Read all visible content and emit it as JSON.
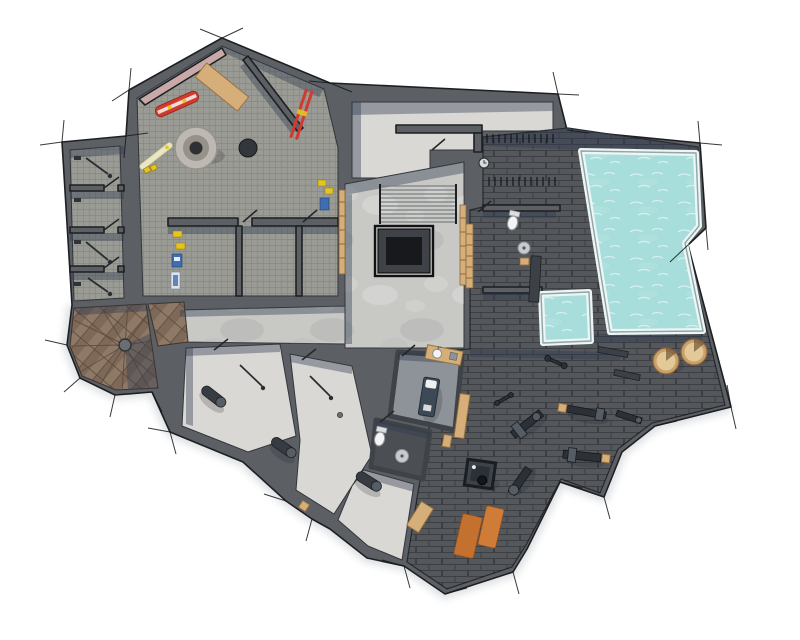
{
  "scene": {
    "type": "architectural-floor-plan",
    "style": "top-down-3d-render",
    "level": "basement-spa-level",
    "background": "#ffffff"
  },
  "colors": {
    "wall": "#5c6065",
    "wallDark": "#3f4348",
    "wallEdge": "#1d1f22",
    "carpet": "#9a9b95",
    "concrete": "#c8c8c5",
    "plaster": "#dad8d4",
    "tile": "#54585d",
    "tileDark": "#4b4f54",
    "massageFloor": "#8e9399",
    "water": "#a7ddda",
    "poolRim": "#edf5f5",
    "wood": "#d5ae79",
    "woodDark": "#8e7967",
    "shadow": "rgba(47,60,80,0.40)",
    "metal": "#2c3137",
    "metalLight": "#565c63",
    "fixture": "#f3f4f3",
    "mat": "#c4702f",
    "mat2": "#cf7c38",
    "red": "#d23a30",
    "yellow": "#e5c41f",
    "cream": "#eae6c2",
    "tub": "#c9a06a",
    "blue": "#3f6db0",
    "pinkWall": "#c9a9a7"
  },
  "rooms": [
    "ski-room",
    "equipment-lockers",
    "storage-wing",
    "stair-hall",
    "lobby",
    "spa",
    "swimming-pool-terrace",
    "wc",
    "massage-room",
    "gym",
    "cellar-rooms",
    "spiral-staircase-room"
  ],
  "fixtures": {
    "swimming_pool": 1,
    "plunge_pool": 1,
    "hot_tubs": 2,
    "toilets": 2,
    "sinks": 3,
    "massage_tables": 1,
    "gym_machines": 7,
    "yoga_mats": 2,
    "boot_dryer": 1,
    "snowboards": 1,
    "ski_pairs": 2,
    "spiral_staircase": 1,
    "staircases": 2,
    "storage_cylinders": 3
  }
}
